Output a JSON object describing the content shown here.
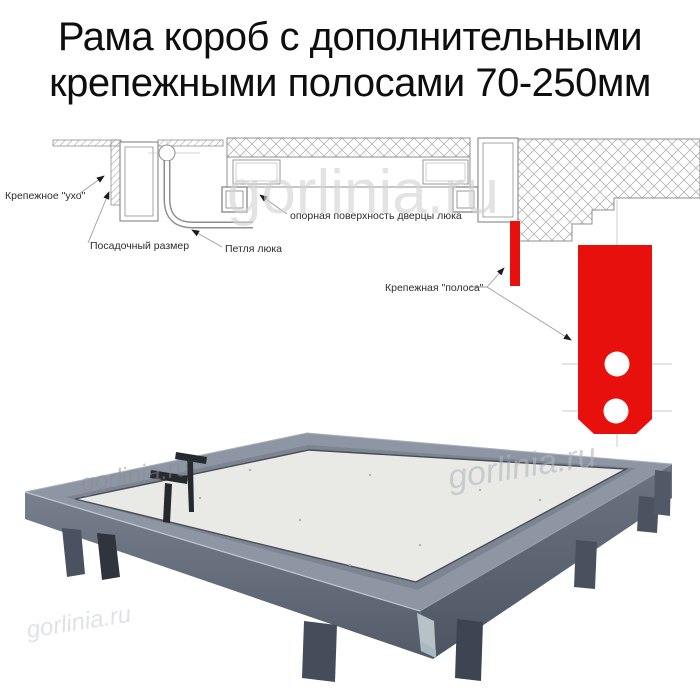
{
  "title": {
    "line1": "Рама короб с дополнительными",
    "line2": "крепежными полосами 70-250мм"
  },
  "watermark": {
    "text": "gorlinia.ru"
  },
  "diagram": {
    "labels": {
      "mounting_ear": "Крепежное \"ухо\"",
      "seating_size": "Посадочный размер",
      "hatch_hinge": "Петля люка",
      "door_bearing_surface": "опорная поверхность дверцы люка",
      "mounting_strip": "Крепежная \"полоса\""
    },
    "colors": {
      "strip_red": "#e8100c",
      "cad_line_gray": "#8f8f8f",
      "centerline_gray": "#c9c9c9"
    }
  },
  "photo": {
    "colors": {
      "frame_top": "#8e96a4",
      "frame_gap": "#7d8593",
      "panel": "#e9eae6",
      "front_face_dark": "#565e6c",
      "legs": "#3e4450",
      "handles": "#26292e"
    }
  }
}
